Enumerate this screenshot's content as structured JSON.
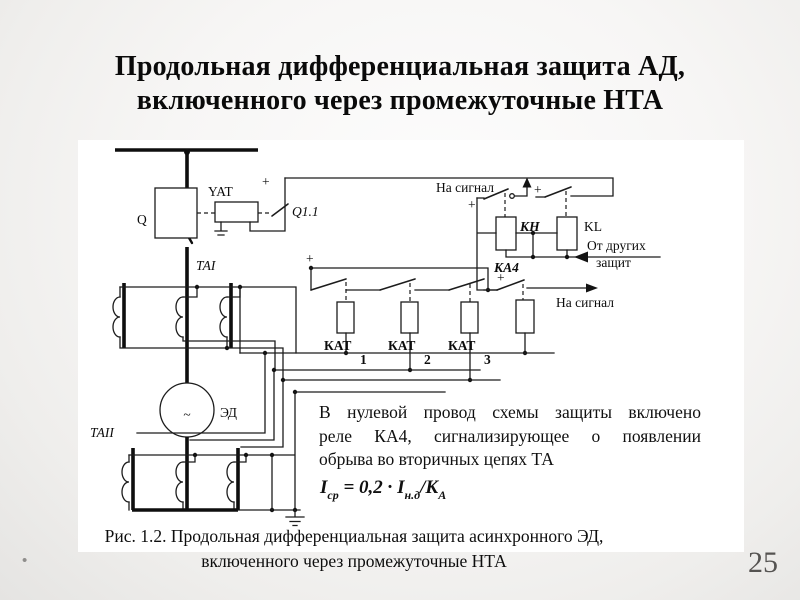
{
  "title": {
    "line1": "Продольная дифференциальная защита АД,",
    "line2": "включенного через промежуточные НТА"
  },
  "note": {
    "line1": "В нулевой провод схемы защиты включено",
    "line2": "реле КА4, сигнализирующее о появлении",
    "line3": "обрыва во вторичных цепях ТА"
  },
  "formula": {
    "i1": "I",
    "sub1": "ср",
    "eq": " = 0,2 · ",
    "i2": "I",
    "sub2": "н.д",
    "den": "/К",
    "sub3": "А"
  },
  "caption": {
    "line1": "Рис. 1.2. Продольная дифференциальная защита асинхронного ЭД,",
    "line2": "включенного через промежуточные НТА"
  },
  "footer": {
    "page_number": "25",
    "bullet": "•"
  },
  "diagram": {
    "labels": {
      "q": "Q",
      "yat": "YAT",
      "q11": "Q1.1",
      "plus": "+",
      "na_signal": "На сигнал",
      "kh": "КН",
      "kl": "KL",
      "ot_drugikh_line1": "От других",
      "ot_drugikh_line2": "защит",
      "ka4": "КА4",
      "kat": "КАТ",
      "kat_sub1": "1",
      "kat_sub2": "2",
      "kat_sub3": "3",
      "ta1": "ТАI",
      "ta2": "ТАII",
      "ed": "ЭД",
      "wave": "~"
    },
    "colors": {
      "line": "#1c1c1c",
      "background": "#ffffff"
    }
  }
}
